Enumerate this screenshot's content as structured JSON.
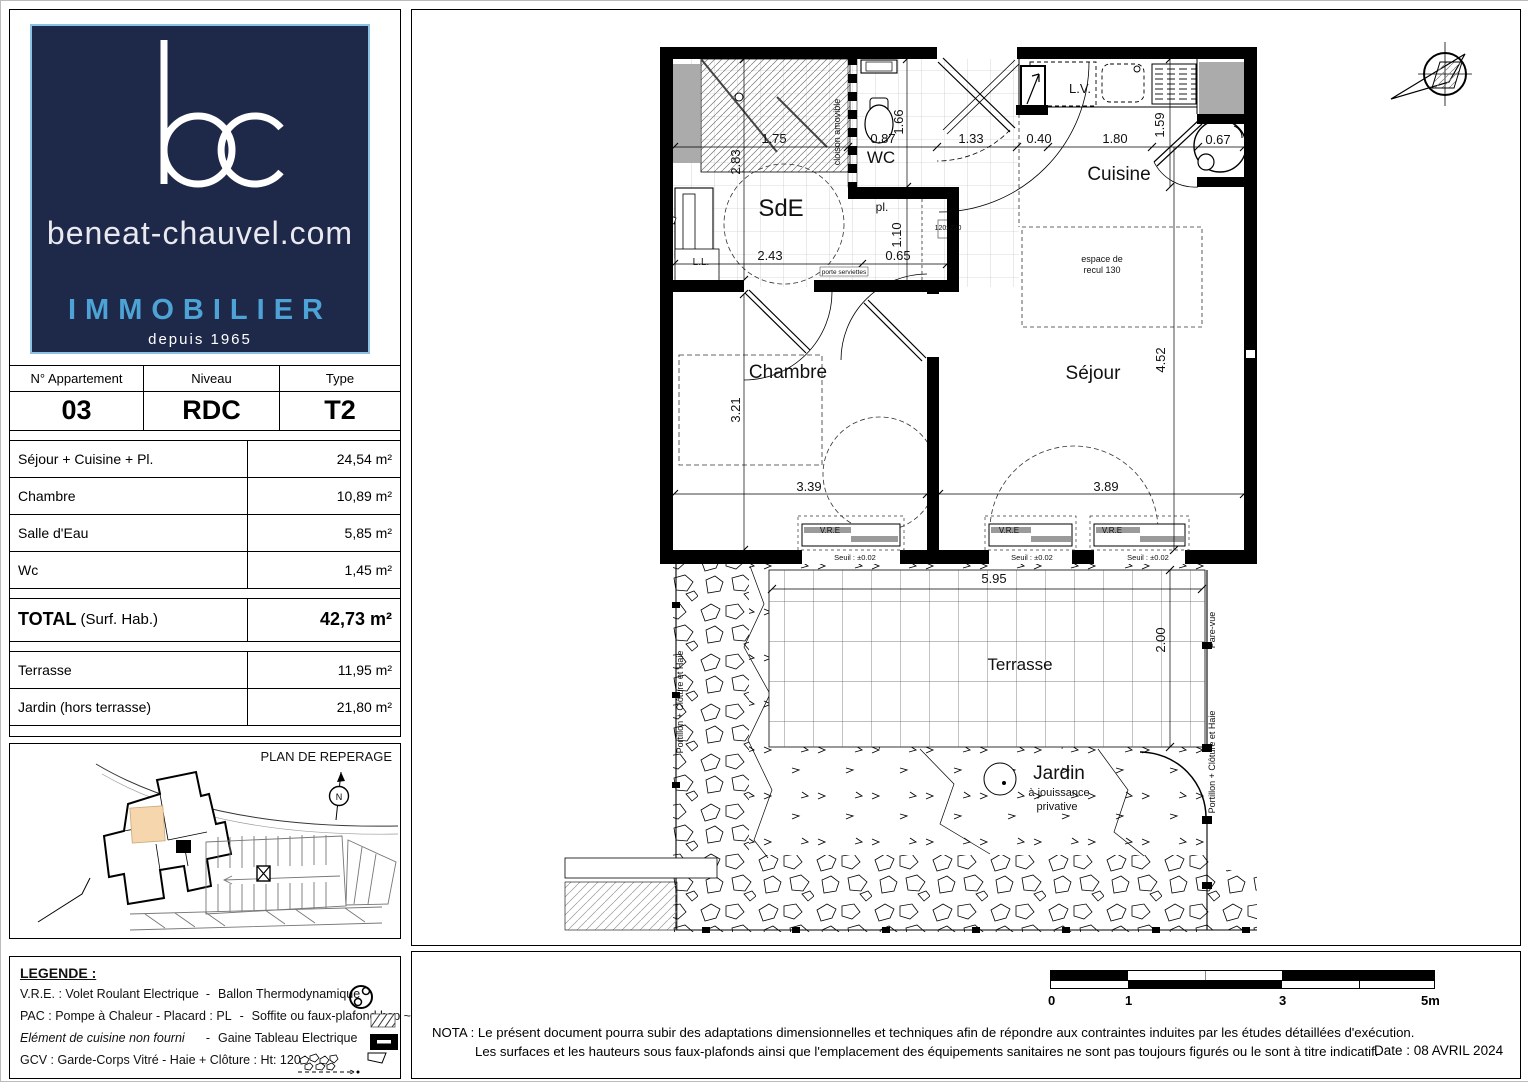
{
  "logo": {
    "monogram": "bc",
    "site": "beneat-chauvel.com",
    "brand": "IMMOBILIER",
    "since": "depuis 1965",
    "bg_color": "#1e2849",
    "accent_color": "#4da3d6"
  },
  "apartment_table": {
    "headers": [
      "N° Appartement",
      "Niveau",
      "Type"
    ],
    "values": [
      "03",
      "RDC",
      "T2"
    ],
    "rows": [
      {
        "label": "Séjour + Cuisine + Pl.",
        "value": "24,54 m²"
      },
      {
        "label": "Chambre",
        "value": "10,89 m²"
      },
      {
        "label": "Salle d'Eau",
        "value": "5,85 m²"
      },
      {
        "label": "Wc",
        "value": "1,45 m²"
      }
    ],
    "total_label": "TOTAL",
    "total_suffix": " (Surf. Hab.)",
    "total_value": "42,73 m²",
    "outdoor_rows": [
      {
        "label": "Terrasse",
        "value": "11,95 m²"
      },
      {
        "label": "Jardin (hors terrasse)",
        "value": "21,80 m²"
      }
    ]
  },
  "reperage": {
    "title": "PLAN DE REPERAGE",
    "highlight_color": "#f6d6ad"
  },
  "legend": {
    "title": "LEGENDE :",
    "rows": [
      {
        "left": "V.R.E. :  Volet Roulant Electrique",
        "sep": "-",
        "right": "Ballon Thermodynamique"
      },
      {
        "left": "PAC : Pompe à Chaleur - Placard : PL",
        "sep": "-",
        "right": "Soffite ou faux-plafond hsp ~230"
      },
      {
        "left": "Elément de cuisine non fourni",
        "sep": "-",
        "right": "Gaine Tableau Electrique"
      },
      {
        "left": "GCV : Garde-Corps Vitré - Haie + Clôture : Ht: 120",
        "sep": "",
        "right": ""
      }
    ]
  },
  "floorplan": {
    "labels": [
      {
        "id": "room-label-sde",
        "t": "SdE",
        "x": 779,
        "y": 214,
        "s": 24
      },
      {
        "id": "room-label-wc",
        "t": "WC",
        "x": 879,
        "y": 161,
        "s": 17
      },
      {
        "id": "room-label-cuisine",
        "t": "Cuisine",
        "x": 1117,
        "y": 178,
        "s": 19
      },
      {
        "id": "room-label-chambre",
        "t": "Chambre",
        "x": 786,
        "y": 376,
        "s": 19
      },
      {
        "id": "room-label-sejour",
        "t": "Séjour",
        "x": 1091,
        "y": 377,
        "s": 19
      },
      {
        "id": "room-label-terrasse",
        "t": "Terrasse",
        "x": 1018,
        "y": 668,
        "s": 17
      },
      {
        "id": "room-label-jardin",
        "t": "Jardin",
        "x": 1057,
        "y": 777,
        "s": 19
      },
      {
        "id": "jardin-sub-1",
        "t": "à jouissance",
        "x": 1057,
        "y": 794,
        "s": 11
      },
      {
        "id": "jardin-sub-2",
        "t": "privative",
        "x": 1055,
        "y": 808,
        "s": 11
      },
      {
        "id": "label-lave-vaisselle",
        "t": "L.V.",
        "x": 1078,
        "y": 91,
        "s": 13
      },
      {
        "id": "label-placard",
        "t": "pl.",
        "x": 880,
        "y": 209,
        "s": 12
      },
      {
        "id": "label-lave-linge",
        "t": "L.L.",
        "x": 699,
        "y": 263,
        "s": 10
      },
      {
        "id": "label-cloison-amovible",
        "t": "cloison amovible",
        "x": 838,
        "y": 130,
        "s": 9,
        "rot": -90
      },
      {
        "id": "label-espace-recul-1",
        "t": "espace de",
        "x": 1100,
        "y": 260,
        "s": 9
      },
      {
        "id": "label-espace-recul-2",
        "t": "recul 130",
        "x": 1100,
        "y": 271,
        "s": 9
      },
      {
        "id": "label-porte-120",
        "t": "120x220",
        "x": 946,
        "y": 228,
        "s": 7
      },
      {
        "id": "label-porte-serviettes",
        "t": "porte serviettes",
        "x": 842,
        "y": 272,
        "s": 6.5
      },
      {
        "id": "dim-1-75",
        "t": "1.75",
        "x": 772,
        "y": 141,
        "s": 13
      },
      {
        "id": "dim-0-87",
        "t": "0.87",
        "x": 881,
        "y": 141,
        "s": 13
      },
      {
        "id": "dim-1-33",
        "t": "0.40",
        "x": 1037,
        "y": 141,
        "s": 13
      },
      {
        "id": "dim-1-33b",
        "t": "1.33",
        "x": 969,
        "y": 141,
        "s": 13
      },
      {
        "id": "dim-1-80",
        "t": "1.80",
        "x": 1113,
        "y": 141,
        "s": 13
      },
      {
        "id": "dim-0-67",
        "t": "0.67",
        "x": 1216,
        "y": 142,
        "s": 13
      },
      {
        "id": "dim-2-83",
        "t": "2.83",
        "x": 738,
        "y": 160,
        "s": 13,
        "rot": -90
      },
      {
        "id": "dim-1-66",
        "t": "1.66",
        "x": 901,
        "y": 120,
        "s": 13,
        "rot": -90
      },
      {
        "id": "dim-1-59",
        "t": "1.59",
        "x": 1162,
        "y": 123,
        "s": 13,
        "rot": -90
      },
      {
        "id": "dim-2-43",
        "t": "2.43",
        "x": 768,
        "y": 258,
        "s": 13
      },
      {
        "id": "dim-0-65",
        "t": "0.65",
        "x": 896,
        "y": 258,
        "s": 13
      },
      {
        "id": "dim-1-10",
        "t": "1.10",
        "x": 899,
        "y": 233,
        "s": 13,
        "rot": -90
      },
      {
        "id": "dim-3-21",
        "t": "3.21",
        "x": 738,
        "y": 408,
        "s": 13,
        "rot": -90
      },
      {
        "id": "dim-3-39",
        "t": "3.39",
        "x": 807,
        "y": 489,
        "s": 13
      },
      {
        "id": "dim-3-89",
        "t": "3.89",
        "x": 1104,
        "y": 489,
        "s": 13
      },
      {
        "id": "dim-4-52",
        "t": "4.52",
        "x": 1163,
        "y": 358,
        "s": 13,
        "rot": -90
      },
      {
        "id": "dim-5-95",
        "t": "5.95",
        "x": 992,
        "y": 581,
        "s": 13
      },
      {
        "id": "dim-2-00",
        "t": "2.00",
        "x": 1163,
        "y": 638,
        "s": 13,
        "rot": -90
      },
      {
        "id": "vre-label-1",
        "t": "V.R.E",
        "x": 828,
        "y": 531,
        "s": 8
      },
      {
        "id": "vre-label-2",
        "t": "V.R.E",
        "x": 1007,
        "y": 531,
        "s": 8
      },
      {
        "id": "vre-label-3",
        "t": "V.R.E",
        "x": 1110,
        "y": 531,
        "s": 8
      },
      {
        "id": "seuil-label-1",
        "t": "Seuil : ±0.02",
        "x": 853,
        "y": 558,
        "s": 7.5
      },
      {
        "id": "seuil-label-2",
        "t": "Seuil : ±0.02",
        "x": 1030,
        "y": 558,
        "s": 7.5
      },
      {
        "id": "seuil-label-3",
        "t": "Seuil : ±0.02",
        "x": 1146,
        "y": 558,
        "s": 7.5
      },
      {
        "id": "fence-label-left",
        "t": "Portillon + Clôture et Haie",
        "x": 681,
        "y": 700,
        "s": 9,
        "rot": -90
      },
      {
        "id": "fence-label-right",
        "t": "Portillon + Clôture et Haie",
        "x": 1213,
        "y": 760,
        "s": 9,
        "rot": -90
      },
      {
        "id": "pare-vue-label",
        "t": "Pare-vue",
        "x": 1213,
        "y": 628,
        "s": 9,
        "rot": -90
      }
    ]
  },
  "scalebar": {
    "labels": [
      "0",
      "1",
      "3",
      "5m"
    ]
  },
  "nota": {
    "line1": "NOTA : Le présent document pourra subir des adaptations dimensionnelles et techniques afin de répondre aux contraintes induites par les études détaillées d'exécution.",
    "line2": "Les surfaces et les hauteurs sous faux-plafonds ainsi que l'emplacement des équipements sanitaires ne sont pas toujours figurés ou le sont à titre indicatif.",
    "date": "Date : 08 AVRIL 2024"
  }
}
